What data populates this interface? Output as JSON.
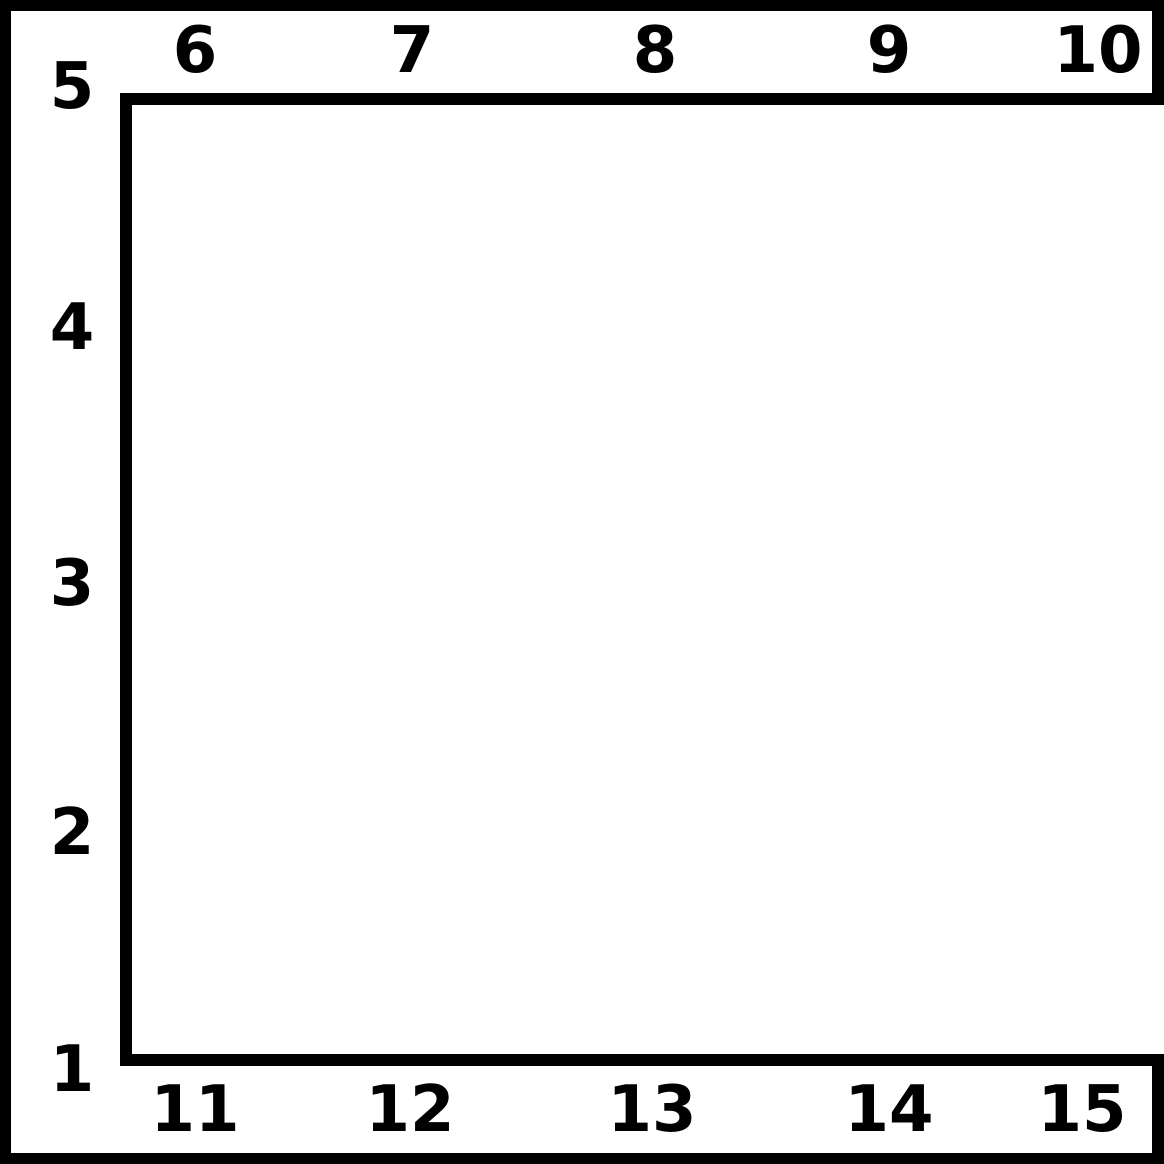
{
  "diagram": {
    "colors": {
      "line": "#000000",
      "background": "#ffffff"
    },
    "left_strip": {
      "labels": [
        "5",
        "4",
        "3",
        "2",
        "1"
      ]
    },
    "top_strip": {
      "labels": [
        "6",
        "7",
        "8",
        "9",
        "10"
      ]
    },
    "bottom_strip": {
      "labels": [
        "11",
        "12",
        "13",
        "14",
        "15"
      ]
    }
  }
}
